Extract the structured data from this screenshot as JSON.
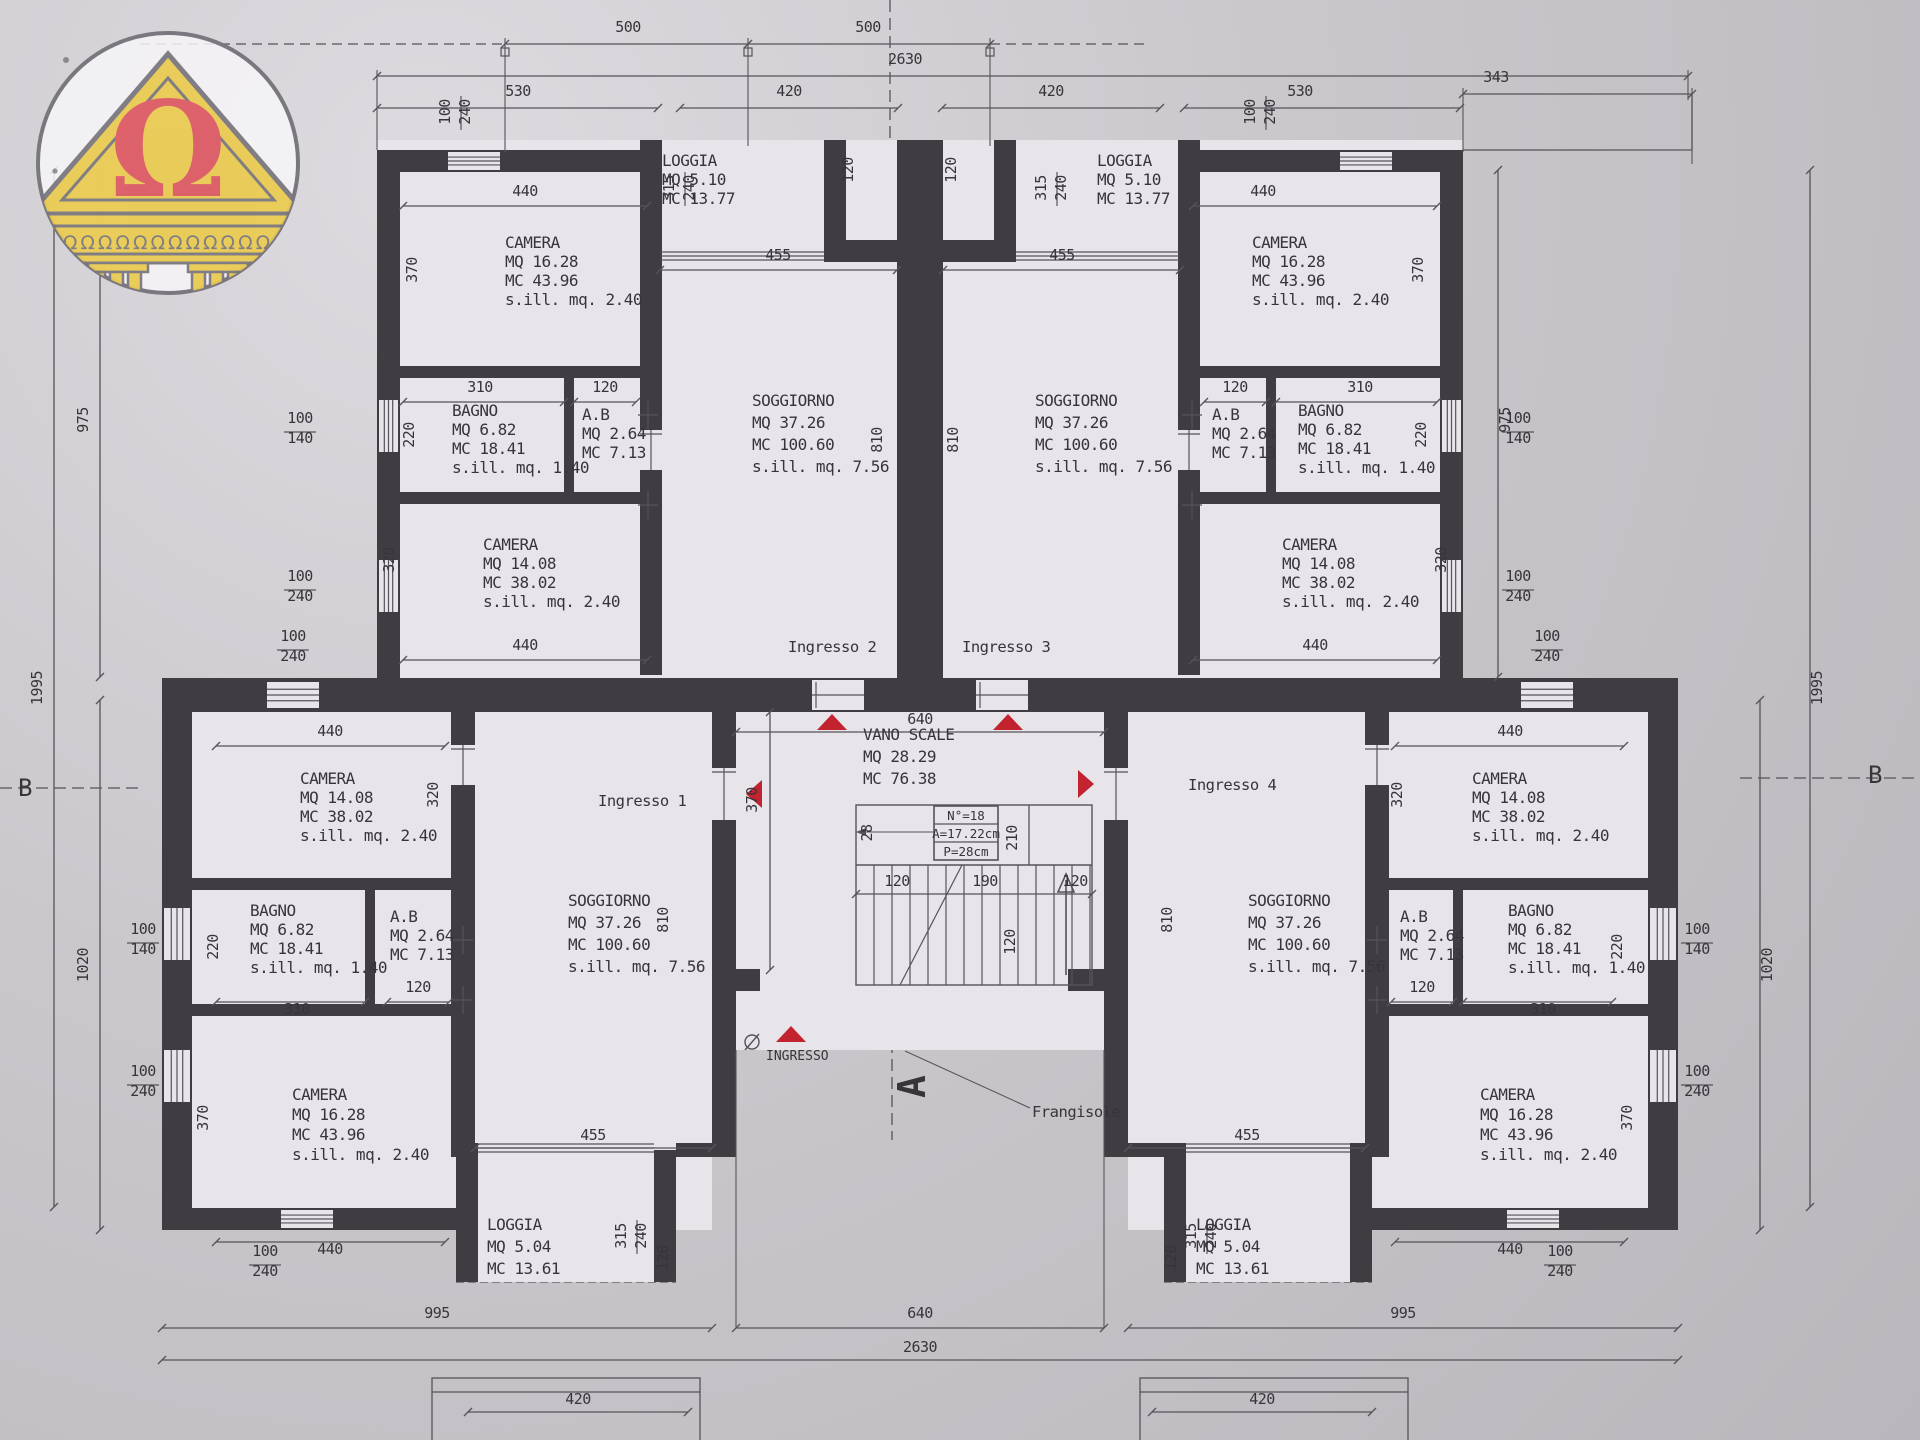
{
  "title": "Floor plan - apartment building (piano tipo)",
  "colors": {
    "paper": "#cac7cb",
    "paper_light": "#dddbdf",
    "paper_dark": "#b9b7bb",
    "room": "#e7e5e9",
    "wall": "#3f3c42",
    "line": "#56535a",
    "text": "#37343a",
    "red": "#c3232e",
    "logo_yellow": "#e9ca52",
    "logo_red": "#dc5a64",
    "logo_gray": "#7a787e"
  },
  "logo": {
    "omega": "Ω",
    "frieze": "ΩΩΩΩΩΩΩΩΩΩΩΩ"
  },
  "rooms": [
    {
      "id": "ul-camera-1",
      "x": 505,
      "y": 248,
      "lh": 19,
      "lines": [
        "CAMERA",
        "MQ 16.28",
        "MC 43.96",
        "s.ill. mq. 2.40"
      ]
    },
    {
      "id": "ul-loggia",
      "x": 662,
      "y": 166,
      "lh": 19,
      "lines": [
        "LOGGIA",
        "MQ 5.10",
        "MC 13.77"
      ]
    },
    {
      "id": "ul-bagno",
      "x": 452,
      "y": 416,
      "lh": 19,
      "lines": [
        "BAGNO",
        "MQ 6.82",
        "MC 18.41",
        "s.ill. mq. 1.40"
      ]
    },
    {
      "id": "ul-ab",
      "x": 582,
      "y": 420,
      "lh": 19,
      "lines": [
        "A.B",
        "MQ 2.64",
        "MC 7.13"
      ]
    },
    {
      "id": "ul-camera-2",
      "x": 483,
      "y": 550,
      "lh": 19,
      "lines": [
        "CAMERA",
        "MQ 14.08",
        "MC 38.02",
        "s.ill. mq. 2.40"
      ]
    },
    {
      "id": "ul-soggiorno",
      "x": 752,
      "y": 406,
      "lh": 22,
      "lines": [
        "SOGGIORNO",
        "MQ 37.26",
        "MC 100.60",
        "s.ill. mq. 7.56"
      ]
    },
    {
      "id": "ur-loggia",
      "x": 1097,
      "y": 166,
      "lh": 19,
      "lines": [
        "LOGGIA",
        "MQ 5.10",
        "MC 13.77"
      ]
    },
    {
      "id": "ur-camera-1",
      "x": 1252,
      "y": 248,
      "lh": 19,
      "lines": [
        "CAMERA",
        "MQ 16.28",
        "MC 43.96",
        "s.ill. mq. 2.40"
      ]
    },
    {
      "id": "ur-ab",
      "x": 1212,
      "y": 420,
      "lh": 19,
      "lines": [
        "A.B",
        "MQ 2.64",
        "MC 7.13"
      ]
    },
    {
      "id": "ur-bagno",
      "x": 1298,
      "y": 416,
      "lh": 19,
      "lines": [
        "BAGNO",
        "MQ 6.82",
        "MC 18.41",
        "s.ill. mq. 1.40"
      ]
    },
    {
      "id": "ur-camera-2",
      "x": 1282,
      "y": 550,
      "lh": 19,
      "lines": [
        "CAMERA",
        "MQ 14.08",
        "MC 38.02",
        "s.ill. mq. 2.40"
      ]
    },
    {
      "id": "ur-soggiorno",
      "x": 1035,
      "y": 406,
      "lh": 22,
      "lines": [
        "SOGGIORNO",
        "MQ 37.26",
        "MC 100.60",
        "s.ill. mq. 7.56"
      ]
    },
    {
      "id": "vano-scale",
      "x": 863,
      "y": 740,
      "lh": 22,
      "lines": [
        "VANO SCALE",
        "MQ 28.29",
        "MC 76.38"
      ]
    },
    {
      "id": "ll-camera-1408",
      "x": 300,
      "y": 784,
      "lh": 19,
      "lines": [
        "CAMERA",
        "MQ 14.08",
        "MC 38.02",
        "s.ill. mq. 2.40"
      ]
    },
    {
      "id": "ll-bagno",
      "x": 250,
      "y": 916,
      "lh": 19,
      "lines": [
        "BAGNO",
        "MQ 6.82",
        "MC 18.41",
        "s.ill. mq. 1.40"
      ]
    },
    {
      "id": "ll-ab",
      "x": 390,
      "y": 922,
      "lh": 19,
      "lines": [
        "A.B",
        "MQ 2.64",
        "MC 7.13"
      ]
    },
    {
      "id": "ll-camera-1628",
      "x": 292,
      "y": 1100,
      "lh": 20,
      "lines": [
        "CAMERA",
        "MQ 16.28",
        "MC 43.96",
        "s.ill. mq. 2.40"
      ]
    },
    {
      "id": "ll-soggiorno",
      "x": 568,
      "y": 906,
      "lh": 22,
      "lines": [
        "SOGGIORNO",
        "MQ 37.26",
        "MC 100.60",
        "s.ill. mq. 7.56"
      ]
    },
    {
      "id": "ll-loggia",
      "x": 487,
      "y": 1230,
      "lh": 22,
      "lines": [
        "LOGGIA",
        "MQ 5.04",
        "MC 13.61"
      ]
    },
    {
      "id": "rr-camera-1408",
      "x": 1472,
      "y": 784,
      "lh": 19,
      "lines": [
        "CAMERA",
        "MQ 14.08",
        "MC 38.02",
        "s.ill. mq. 2.40"
      ]
    },
    {
      "id": "rr-ab",
      "x": 1400,
      "y": 922,
      "lh": 19,
      "lines": [
        "A.B",
        "MQ 2.64",
        "MC 7.13"
      ]
    },
    {
      "id": "rr-bagno",
      "x": 1508,
      "y": 916,
      "lh": 19,
      "lines": [
        "BAGNO",
        "MQ 6.82",
        "MC 18.41",
        "s.ill. mq. 1.40"
      ]
    },
    {
      "id": "rr-camera-1628",
      "x": 1480,
      "y": 1100,
      "lh": 20,
      "lines": [
        "CAMERA",
        "MQ 16.28",
        "MC 43.96",
        "s.ill. mq. 2.40"
      ]
    },
    {
      "id": "rr-soggiorno",
      "x": 1248,
      "y": 906,
      "lh": 22,
      "lines": [
        "SOGGIORNO",
        "MQ 37.26",
        "MC 100.60",
        "s.ill. mq. 7.56"
      ]
    },
    {
      "id": "rr-loggia",
      "x": 1196,
      "y": 1230,
      "lh": 22,
      "lines": [
        "LOGGIA",
        "MQ 5.04",
        "MC 13.61"
      ]
    }
  ],
  "dims": [
    {
      "t": "500",
      "x": 628,
      "y": 32
    },
    {
      "t": "500",
      "x": 868,
      "y": 32
    },
    {
      "t": "2630",
      "x": 905,
      "y": 64
    },
    {
      "t": "530",
      "x": 518,
      "y": 96
    },
    {
      "t": "420",
      "x": 789,
      "y": 96
    },
    {
      "t": "420",
      "x": 1051,
      "y": 96
    },
    {
      "t": "530",
      "x": 1300,
      "y": 96
    },
    {
      "t": "343",
      "x": 1496,
      "y": 82
    },
    {
      "t": "100",
      "x": 450,
      "y": 112,
      "r": 1
    },
    {
      "t": "240",
      "x": 470,
      "y": 112,
      "r": 1
    },
    {
      "t": "315",
      "x": 674,
      "y": 188,
      "r": 1
    },
    {
      "t": "240",
      "x": 694,
      "y": 188,
      "r": 1
    },
    {
      "t": "120",
      "x": 853,
      "y": 170,
      "r": 1
    },
    {
      "t": "120",
      "x": 956,
      "y": 170,
      "r": 1
    },
    {
      "t": "315",
      "x": 1046,
      "y": 188,
      "r": 1
    },
    {
      "t": "240",
      "x": 1066,
      "y": 188,
      "r": 1
    },
    {
      "t": "100",
      "x": 1255,
      "y": 112,
      "r": 1
    },
    {
      "t": "240",
      "x": 1275,
      "y": 112,
      "r": 1
    },
    {
      "t": "440",
      "x": 525,
      "y": 196
    },
    {
      "t": "440",
      "x": 1263,
      "y": 196
    },
    {
      "t": "455",
      "x": 778,
      "y": 260
    },
    {
      "t": "455",
      "x": 1062,
      "y": 260
    },
    {
      "t": "370",
      "x": 417,
      "y": 270,
      "r": 1
    },
    {
      "t": "370",
      "x": 1423,
      "y": 270,
      "r": 1
    },
    {
      "t": "310",
      "x": 480,
      "y": 392
    },
    {
      "t": "120",
      "x": 605,
      "y": 392
    },
    {
      "t": "120",
      "x": 1235,
      "y": 392
    },
    {
      "t": "310",
      "x": 1360,
      "y": 392
    },
    {
      "t": "220",
      "x": 414,
      "y": 435,
      "r": 1
    },
    {
      "t": "220",
      "x": 1426,
      "y": 435,
      "r": 1
    },
    {
      "t": "100",
      "x": 300,
      "y": 423
    },
    {
      "t": "140",
      "x": 300,
      "y": 443
    },
    {
      "t": "100",
      "x": 1518,
      "y": 423
    },
    {
      "t": "140",
      "x": 1518,
      "y": 443
    },
    {
      "t": "100",
      "x": 300,
      "y": 581
    },
    {
      "t": "240",
      "x": 300,
      "y": 601
    },
    {
      "t": "100",
      "x": 1518,
      "y": 581
    },
    {
      "t": "240",
      "x": 1518,
      "y": 601
    },
    {
      "t": "810",
      "x": 882,
      "y": 440,
      "r": 1
    },
    {
      "t": "810",
      "x": 958,
      "y": 440,
      "r": 1
    },
    {
      "t": "320",
      "x": 394,
      "y": 560,
      "r": 1
    },
    {
      "t": "320",
      "x": 1446,
      "y": 560,
      "r": 1
    },
    {
      "t": "440",
      "x": 525,
      "y": 650
    },
    {
      "t": "440",
      "x": 1315,
      "y": 650
    },
    {
      "t": "640",
      "x": 920,
      "y": 724
    },
    {
      "t": "370",
      "x": 757,
      "y": 800,
      "r": 1
    },
    {
      "t": "28",
      "x": 872,
      "y": 833,
      "r": 1
    },
    {
      "t": "210",
      "x": 1017,
      "y": 838,
      "r": 1
    },
    {
      "t": "120",
      "x": 897,
      "y": 886
    },
    {
      "t": "190",
      "x": 985,
      "y": 886
    },
    {
      "t": "120",
      "x": 1075,
      "y": 886
    },
    {
      "t": "120",
      "x": 1015,
      "y": 942,
      "r": 1
    },
    {
      "t": "100",
      "x": 293,
      "y": 641
    },
    {
      "t": "240",
      "x": 293,
      "y": 661
    },
    {
      "t": "100",
      "x": 1547,
      "y": 641
    },
    {
      "t": "240",
      "x": 1547,
      "y": 661
    },
    {
      "t": "440",
      "x": 330,
      "y": 736
    },
    {
      "t": "440",
      "x": 1510,
      "y": 736
    },
    {
      "t": "320",
      "x": 438,
      "y": 795,
      "r": 1
    },
    {
      "t": "320",
      "x": 1402,
      "y": 795,
      "r": 1
    },
    {
      "t": "810",
      "x": 668,
      "y": 920,
      "r": 1
    },
    {
      "t": "810",
      "x": 1172,
      "y": 920,
      "r": 1
    },
    {
      "t": "310",
      "x": 297,
      "y": 1014
    },
    {
      "t": "120",
      "x": 418,
      "y": 992
    },
    {
      "t": "220",
      "x": 218,
      "y": 947,
      "r": 1
    },
    {
      "t": "220",
      "x": 1622,
      "y": 947,
      "r": 1
    },
    {
      "t": "310",
      "x": 1543,
      "y": 1014
    },
    {
      "t": "120",
      "x": 1422,
      "y": 992
    },
    {
      "t": "100",
      "x": 143,
      "y": 934
    },
    {
      "t": "140",
      "x": 143,
      "y": 954
    },
    {
      "t": "100",
      "x": 1697,
      "y": 934
    },
    {
      "t": "140",
      "x": 1697,
      "y": 954
    },
    {
      "t": "370",
      "x": 208,
      "y": 1118,
      "r": 1
    },
    {
      "t": "370",
      "x": 1632,
      "y": 1118,
      "r": 1
    },
    {
      "t": "100",
      "x": 143,
      "y": 1076
    },
    {
      "t": "240",
      "x": 143,
      "y": 1096
    },
    {
      "t": "100",
      "x": 1697,
      "y": 1076
    },
    {
      "t": "240",
      "x": 1697,
      "y": 1096
    },
    {
      "t": "455",
      "x": 593,
      "y": 1140
    },
    {
      "t": "455",
      "x": 1247,
      "y": 1140
    },
    {
      "t": "440",
      "x": 330,
      "y": 1254
    },
    {
      "t": "440",
      "x": 1510,
      "y": 1254
    },
    {
      "t": "100",
      "x": 265,
      "y": 1256
    },
    {
      "t": "240",
      "x": 265,
      "y": 1276
    },
    {
      "t": "100",
      "x": 1560,
      "y": 1256
    },
    {
      "t": "240",
      "x": 1560,
      "y": 1276
    },
    {
      "t": "315",
      "x": 626,
      "y": 1236,
      "r": 1
    },
    {
      "t": "240",
      "x": 646,
      "y": 1236,
      "r": 1
    },
    {
      "t": "120",
      "x": 668,
      "y": 1258,
      "r": 1
    },
    {
      "t": "315",
      "x": 1196,
      "y": 1236,
      "r": 1
    },
    {
      "t": "240",
      "x": 1216,
      "y": 1236,
      "r": 1
    },
    {
      "t": "120",
      "x": 1176,
      "y": 1258,
      "r": 1
    },
    {
      "t": "995",
      "x": 437,
      "y": 1318
    },
    {
      "t": "640",
      "x": 920,
      "y": 1318
    },
    {
      "t": "995",
      "x": 1403,
      "y": 1318
    },
    {
      "t": "2630",
      "x": 920,
      "y": 1352
    },
    {
      "t": "420",
      "x": 578,
      "y": 1404
    },
    {
      "t": "420",
      "x": 1262,
      "y": 1404
    },
    {
      "t": "975",
      "x": 88,
      "y": 420,
      "r": 1
    },
    {
      "t": "1020",
      "x": 88,
      "y": 965,
      "r": 1
    },
    {
      "t": "1995",
      "x": 42,
      "y": 688,
      "r": 1
    },
    {
      "t": "975",
      "x": 1510,
      "y": 420,
      "r": 1
    },
    {
      "t": "1020",
      "x": 1772,
      "y": 965,
      "r": 1
    },
    {
      "t": "1995",
      "x": 1822,
      "y": 688,
      "r": 1
    }
  ],
  "stair_box": {
    "rows": [
      "N°=18",
      "A=17.22cm",
      "P=28cm"
    ]
  },
  "entrances": [
    {
      "id": "ingresso-2",
      "t": "Ingresso  2",
      "x": 788,
      "y": 652
    },
    {
      "id": "ingresso-3",
      "t": "Ingresso  3",
      "x": 962,
      "y": 652
    },
    {
      "id": "ingresso-1",
      "t": "Ingresso  1",
      "x": 598,
      "y": 806
    },
    {
      "id": "ingresso-4",
      "t": "Ingresso  4",
      "x": 1188,
      "y": 790
    }
  ],
  "misc": [
    {
      "id": "ingresso-main",
      "t": "INGRESSO",
      "x": 766,
      "y": 1060,
      "cls": "small"
    },
    {
      "id": "frangisole",
      "t": "Frangisole",
      "x": 1032,
      "y": 1117,
      "cls": "ing"
    },
    {
      "id": "section-a",
      "t": "A",
      "x": 925,
      "y": 1098,
      "cls": "amark",
      "rot": -90
    },
    {
      "id": "section-b-left",
      "t": "B",
      "x": 18,
      "y": 796,
      "cls": "bmark"
    },
    {
      "id": "section-b-right",
      "t": "B",
      "x": 1868,
      "y": 783,
      "cls": "bmark"
    }
  ]
}
